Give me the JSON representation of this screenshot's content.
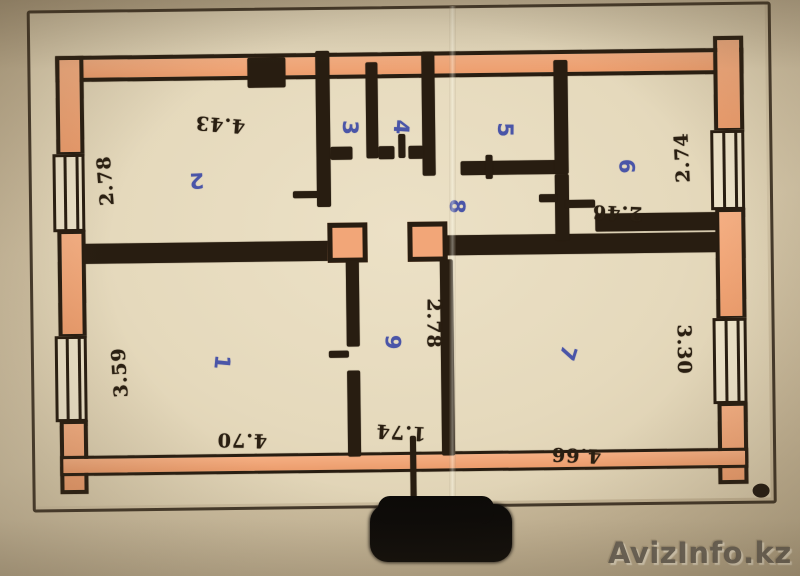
{
  "rooms": {
    "r1": {
      "number": "1",
      "width": "4.70",
      "depth": "3.59"
    },
    "r2": {
      "number": "2",
      "width": "4.43",
      "depth": "2.78"
    },
    "r3": {
      "number": "3"
    },
    "r4": {
      "number": "4"
    },
    "r5": {
      "number": "5"
    },
    "r6": {
      "number": "6",
      "width": "2.46",
      "depth": "2.74"
    },
    "r7": {
      "number": "7",
      "width": "4.66",
      "depth": "3.30"
    },
    "r8": {
      "number": "8"
    },
    "r9": {
      "number": "9",
      "width": "1.74",
      "depth": "2.78"
    }
  },
  "watermark": {
    "text": "AvizInfo.kz"
  },
  "colors": {
    "wall_fill": "#f0a276",
    "ink": "#281d11",
    "room_number_ink": "#4a55a8",
    "paper": "#e7dbc0",
    "watermark_gray": "#6a645a"
  }
}
